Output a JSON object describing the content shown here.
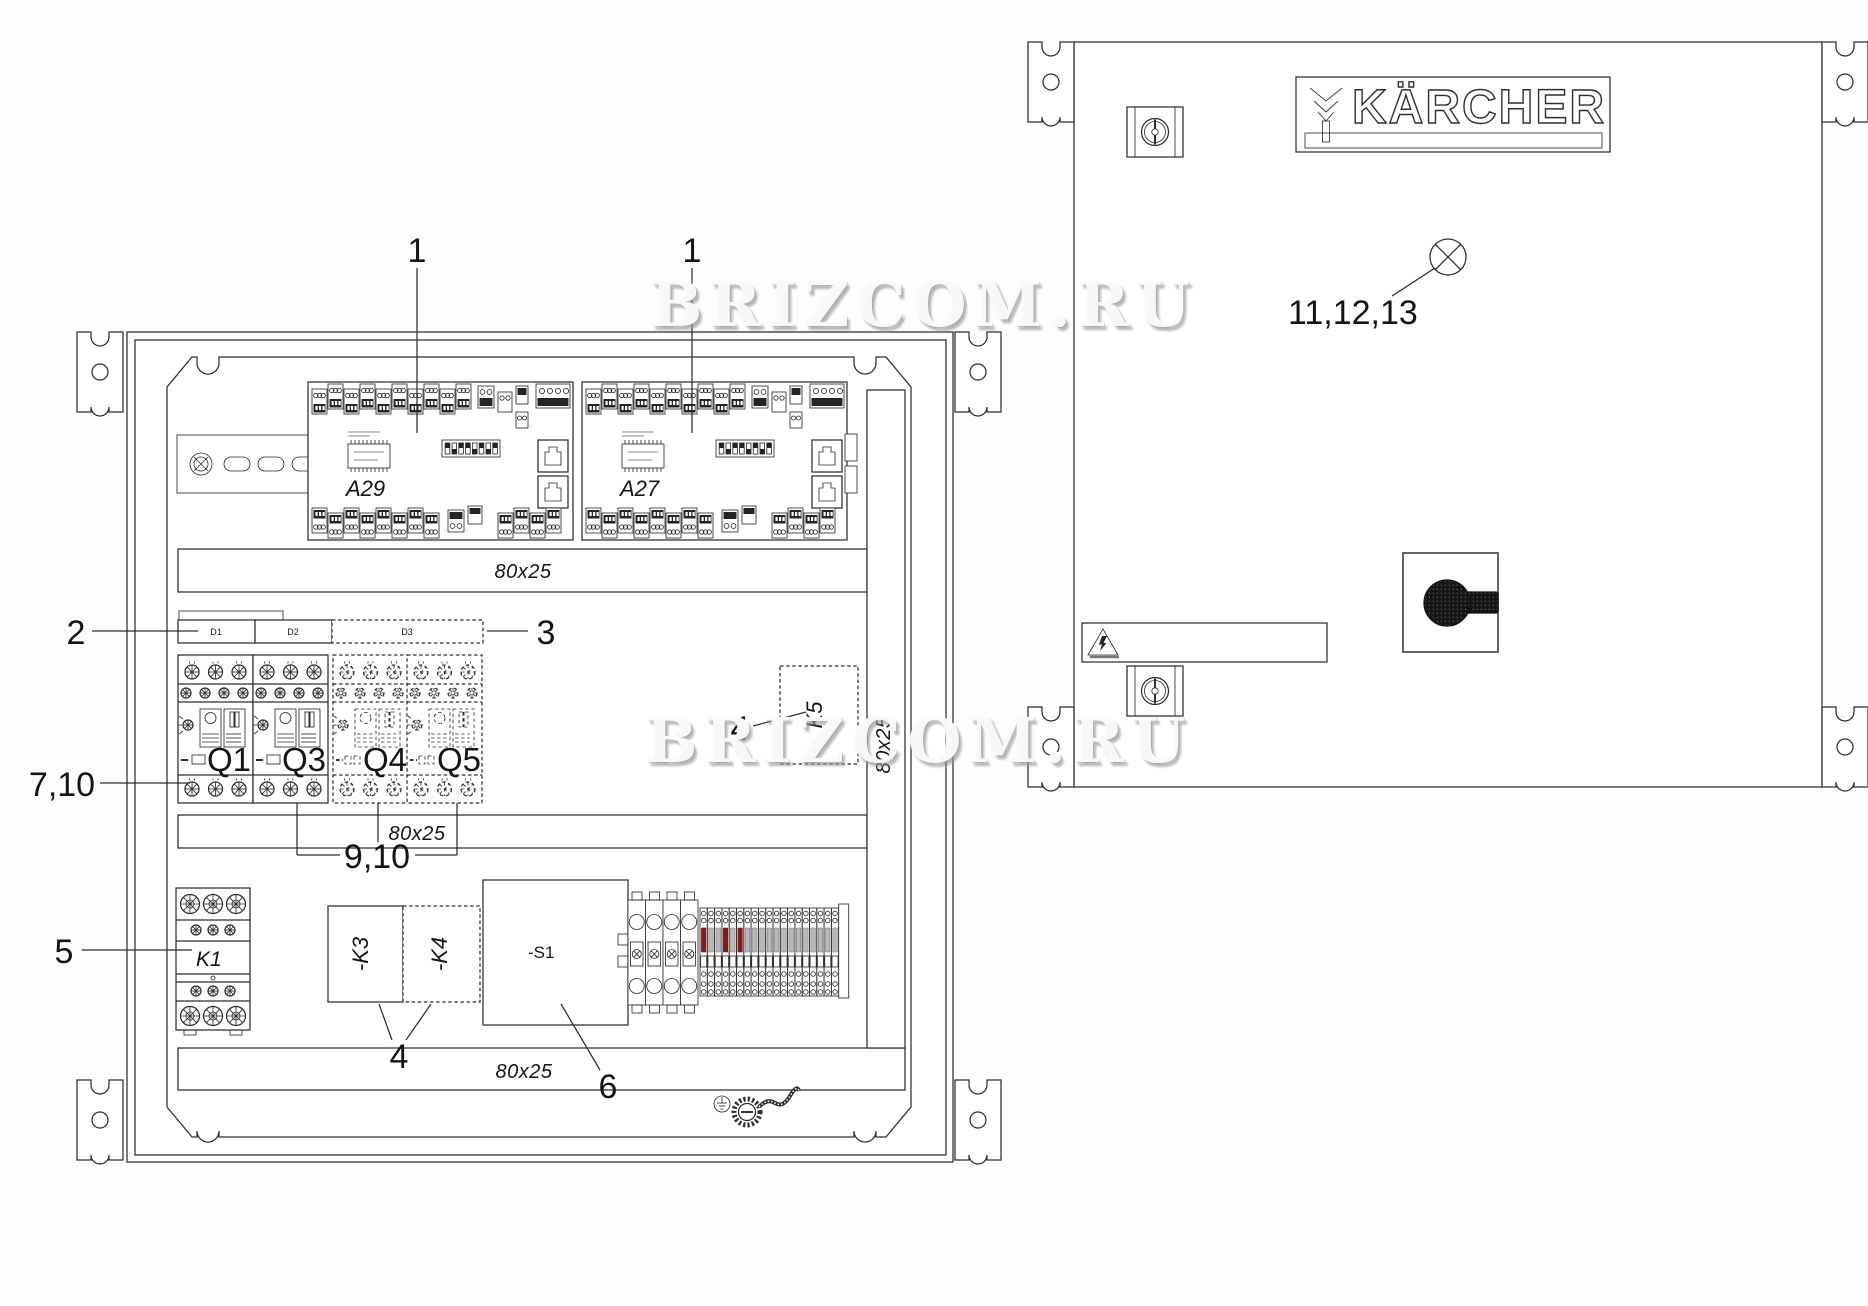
{
  "watermark": {
    "text": "BRIZCOM.RU"
  },
  "door": {
    "brand": "KÄRCHER",
    "lamp_callout": "11,12,13"
  },
  "cabinet": {
    "callout_board_left": "1",
    "callout_board_right": "1",
    "callout_d1": "2",
    "callout_d3": "3",
    "callout_k5": "4",
    "callout_k3k4": "4",
    "callout_k1": "5",
    "callout_s1": "6",
    "callout_q1": "7,10",
    "callout_q345": "9,10",
    "boards": [
      {
        "label": "A29"
      },
      {
        "label": "A27"
      }
    ],
    "d_modules": [
      {
        "label": "D1"
      },
      {
        "label": "D2"
      },
      {
        "label": "D3"
      }
    ],
    "breakers": [
      {
        "label": "Q1"
      },
      {
        "label": "Q3"
      },
      {
        "label": "Q4"
      },
      {
        "label": "Q5"
      }
    ],
    "contactors": {
      "k1": "K1",
      "k3": "-K3",
      "k4": "-K4",
      "k5": "K5"
    },
    "switch_s1": "-S1",
    "rails": {
      "top": "80x25",
      "middle": "80x25",
      "bottom": "80x25",
      "vertical": "80x25"
    }
  },
  "colors": {
    "line": "#2e2e2e",
    "terminal_red": "#8c1818",
    "terminal_gray": "#b8b8b8"
  }
}
